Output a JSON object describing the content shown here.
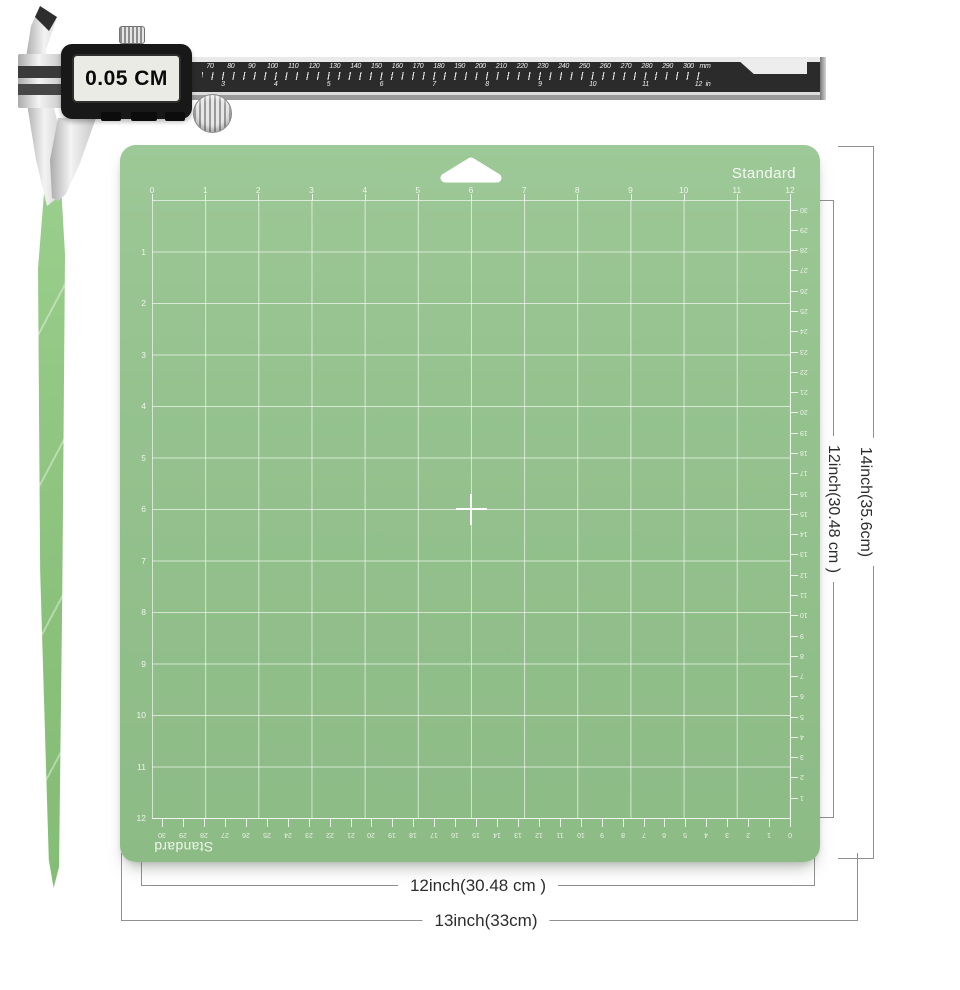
{
  "caliper": {
    "display_value": "0.05 CM",
    "mm_labels": [
      "70",
      "80",
      "90",
      "100",
      "110",
      "120",
      "130",
      "140",
      "150",
      "160",
      "170",
      "180",
      "190",
      "200",
      "210",
      "220",
      "230",
      "240",
      "250",
      "260",
      "270",
      "280",
      "290",
      "300"
    ],
    "mm_unit": "mm",
    "inch_labels": [
      "3",
      "4",
      "5",
      "6",
      "7",
      "8",
      "9",
      "10",
      "11",
      "12"
    ],
    "inch_unit": "in"
  },
  "mat": {
    "brand_top": "Standard",
    "brand_bottom": "Standard",
    "top_inch_numbers": [
      "0",
      "1",
      "2",
      "3",
      "4",
      "5",
      "6",
      "7",
      "8",
      "9",
      "10",
      "11",
      "12"
    ],
    "left_inch_numbers": [
      "1",
      "2",
      "3",
      "4",
      "5",
      "6",
      "7",
      "8",
      "9",
      "10",
      "11",
      "12"
    ],
    "right_cm_numbers": [
      "30",
      "29",
      "28",
      "27",
      "26",
      "25",
      "24",
      "23",
      "22",
      "21",
      "20",
      "19",
      "18",
      "17",
      "16",
      "15",
      "14",
      "13",
      "12",
      "11",
      "10",
      "9",
      "8",
      "7",
      "6",
      "5",
      "4",
      "3",
      "2",
      "1"
    ],
    "bottom_cm_numbers": [
      "30",
      "29",
      "28",
      "27",
      "26",
      "25",
      "24",
      "23",
      "22",
      "21",
      "20",
      "19",
      "18",
      "17",
      "16",
      "15",
      "14",
      "13",
      "12",
      "11",
      "10",
      "9",
      "8",
      "7",
      "6",
      "5",
      "4",
      "3",
      "2",
      "1",
      "0"
    ]
  },
  "dimensions": {
    "grid_height_label": "12inch(30.48 cm )",
    "mat_height_label": "14inch(35.6cm)",
    "grid_width_label": "12inch(30.48 cm )",
    "mat_width_label": "13inch(33cm)"
  },
  "colors": {
    "mat_green": "#95c28e",
    "grid_line": "#ffffff",
    "mat_text": "#edf5ea",
    "dimension_line": "#8f8f8f",
    "dimension_text": "#2d2d2d",
    "beam_dark": "#2b2b2b",
    "metal_silver": "#d9d9d9",
    "display_screen": "#ebebe6",
    "strip_green": "#8ac17b"
  }
}
